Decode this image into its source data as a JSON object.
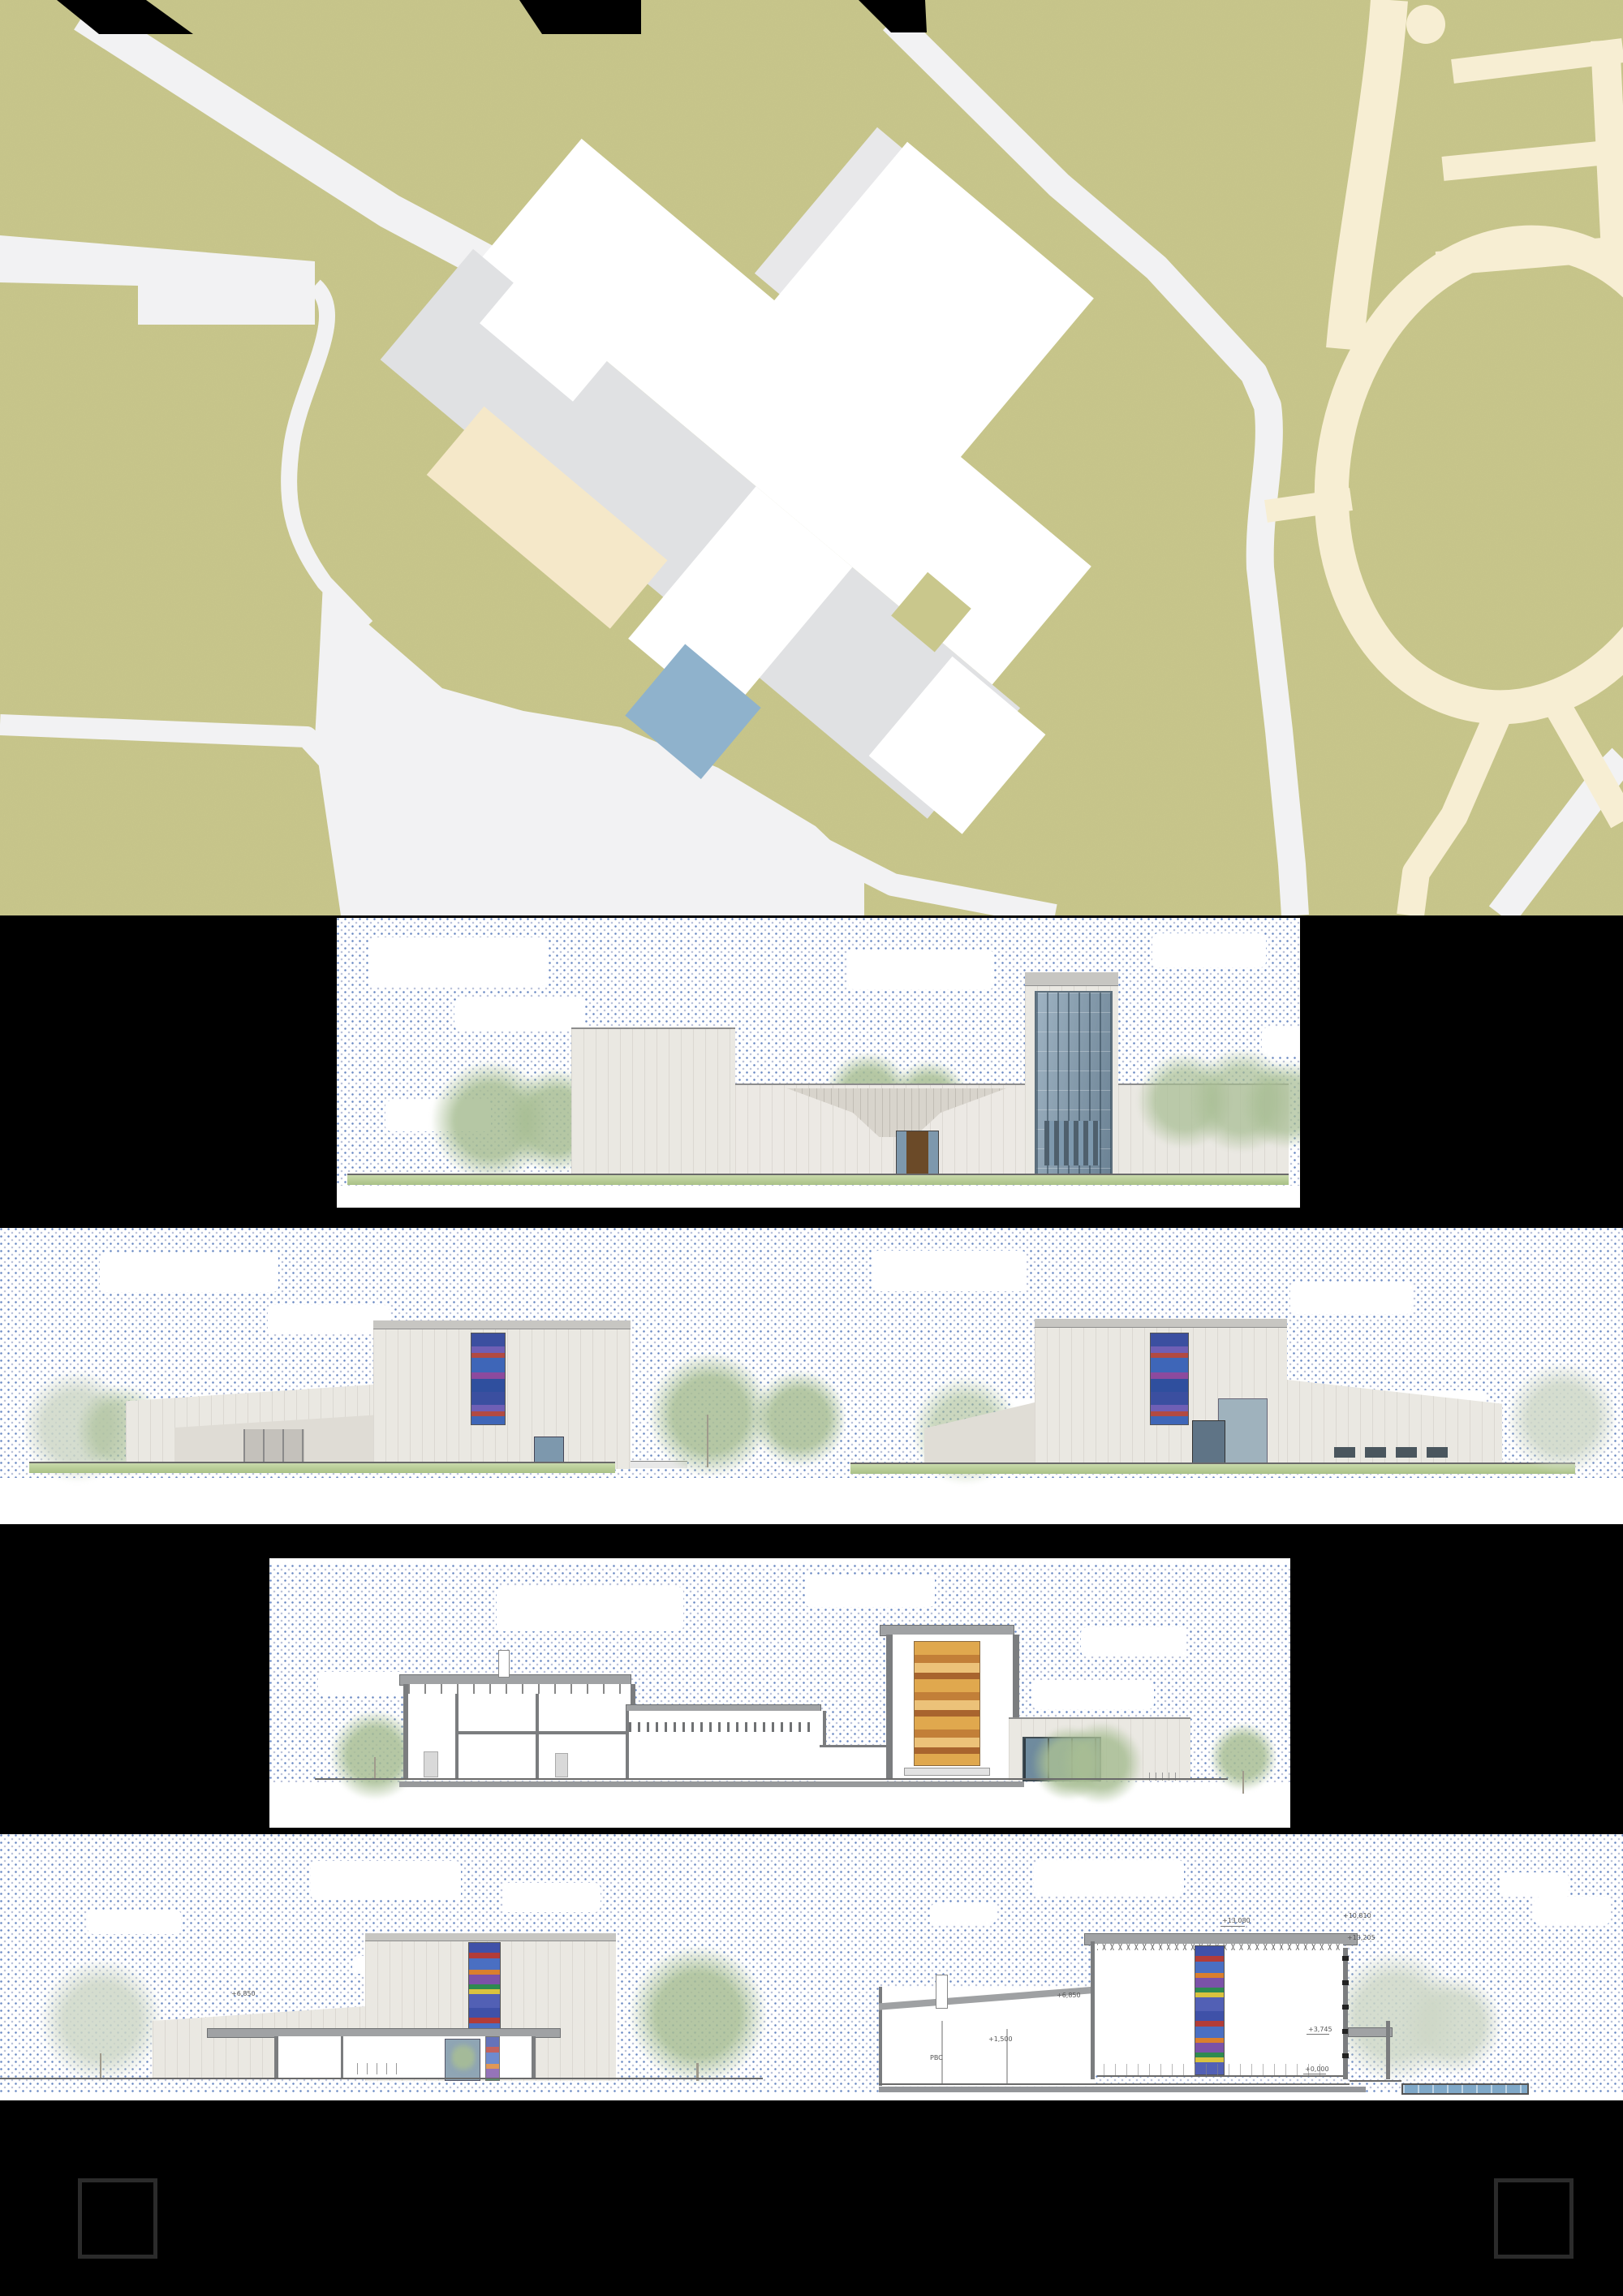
{
  "board": {
    "kind": "architectural presentation board",
    "background": "#000000",
    "panels": [
      {
        "key": "site-plan"
      },
      {
        "key": "entrance-elevation"
      },
      {
        "key": "side-elevations"
      },
      {
        "key": "longitudinal-section"
      },
      {
        "key": "cross-sections"
      }
    ]
  },
  "site_plan": {
    "colors": {
      "grass": "#c9c78c",
      "path": "#f2f2f3",
      "plaza": "#e0e1e3",
      "building": "#ffffff",
      "secondary_path": "#f7eed3",
      "forecourt": "#f5e8c9",
      "pool": "#8fb2cc"
    }
  },
  "sky": {
    "dot_color": "#4f73b7",
    "dot_color_light": "#a9b4cf"
  },
  "annotations": {
    "left_section": [
      {
        "text": "+6,850"
      }
    ],
    "right_section": [
      {
        "text": "+13,080"
      },
      {
        "text": "+10,810"
      },
      {
        "text": "+13,205"
      },
      {
        "text": "+6,850"
      },
      {
        "text": "+3,745"
      },
      {
        "text": "+1,500"
      },
      {
        "text": "+0,000"
      },
      {
        "text": "PBC"
      }
    ]
  },
  "footer": {
    "registration_marks": 2
  }
}
